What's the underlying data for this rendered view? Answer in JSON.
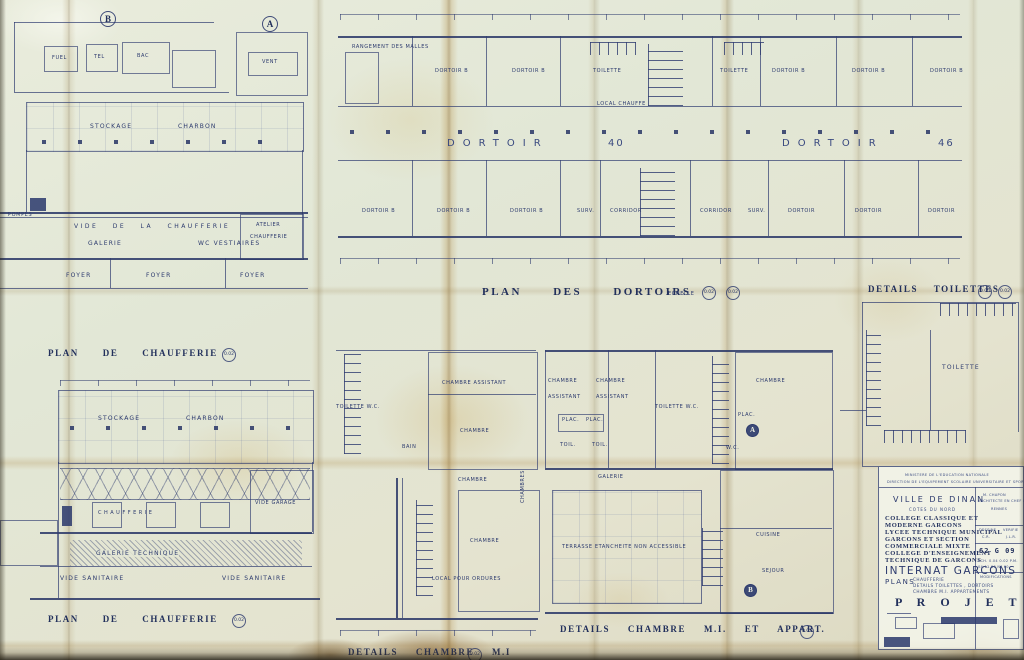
{
  "titles": {
    "plan_dortoirs": "PLAN DES DORTOIRS",
    "details_toilettes": "DETAILS TOILETTES",
    "plan_chaufferie": "PLAN DE CHAUFFERIE",
    "plan_chaufferie2": "PLAN DE CHAUFFERIE",
    "details_chambre": "DETAILS CHAMBRE M.I",
    "details_chambre_appart": "DETAILS CHAMBRE M.I. ET APPART.",
    "echelle": "ECHELLE",
    "s002": "0.02",
    "s005": "0.05"
  },
  "dortoirs": {
    "rangement": "RANGEMENT  DES  MALLES",
    "top_rooms": [
      "DORTOIR  B",
      "DORTOIR  B",
      "TOILETTE",
      "TOILETTE",
      "DORTOIR  B",
      "DORTOIR  B",
      "DORTOIR  B"
    ],
    "hall_left_name": "DORTOIR",
    "hall_left_no": "40",
    "hall_right_name": "DORTOIR",
    "hall_right_no": "46",
    "local": "LOCAL  CHAUFFE",
    "bottom_rooms": [
      "DORTOIR  B",
      "DORTOIR  B",
      "DORTOIR  B",
      "SURV.",
      "CORRIDOR",
      "CORRIDOR",
      "SURV.",
      "DORTOIR",
      "DORTOIR",
      "DORTOIR"
    ]
  },
  "chaufferie_top": {
    "stockage": "STOCKAGE",
    "charbon": "CHARBON",
    "vide": "VIDE  DE  LA  CHAUFFERIE",
    "atelier1": "ATELIER",
    "atelier2": "CHAUFFERIE",
    "galerie": "GALERIE",
    "vestiaires": "WC   VESTIAIRES",
    "pompes": "POMPES",
    "foyer": "FOYER"
  },
  "details_ab": {
    "b": "B",
    "a": "A",
    "fuel": "FUEL",
    "tel": "TEL",
    "bac": "BAC",
    "vent": "VENT"
  },
  "chaufferie_bottom": {
    "stockage": "STOCKAGE",
    "charbon": "CHARBON",
    "chaufferie": "CHAUFFERIE",
    "galerie_technique": "GALERIE   TECHNIQUE",
    "vide_sanitaire": "VIDE  SANITAIRE",
    "vide_garage": "VIDE  GARAGE"
  },
  "chambre_mi": {
    "toilette_wc": "TOILETTE   W.C.",
    "chambre_assistant": "CHAMBRE  ASSISTANT",
    "bain": "BAIN",
    "chambre": "CHAMBRE",
    "local_ordures": "LOCAL  POUR  ORDURES",
    "chambres_vert": "CHAMBRES"
  },
  "appart": {
    "chambre": "CHAMBRE",
    "assistant": "ASSISTANT",
    "toilette_wc": "TOILETTE   W.C.",
    "plac": "PLAC.",
    "toil": "TOIL.",
    "wc": "W.C.",
    "a": "A",
    "b": "B",
    "galerie": "GALERIE",
    "terrasse": "TERRASSE   ETANCHEITE   NON   ACCESSIBLE",
    "cuisine": "CUISINE",
    "sejour": "SEJOUR"
  },
  "toilettes_detail": {
    "toilette": "TOILETTE"
  },
  "title_block": {
    "ministry_line1": "MINISTERE  DE  L'EDUCATION  NATIONALE",
    "ministry_line2": "DIRECTION DE L'EQUIPEMENT SCOLAIRE UNIVERSITAIRE ET SPORTIF",
    "city": "VILLE  DE  DINAN",
    "dept": "COTES  DU  NORD",
    "establishment_lines": [
      "COLLEGE  CLASSIQUE  ET",
      "MODERNE  GARCONS",
      "LYCEE  TECHNIQUE  MUNICIPAL",
      "GARCONS  ET  SECTION",
      "COMMERCIALE  MIXTE",
      "COLLEGE  D'ENSEIGNEMENT",
      "TECHNIQUE  DE  GARCONS"
    ],
    "project": "INTERNAT  GARCONS",
    "plans_label": "PLANS",
    "plans_lines": [
      "CHAUFFERIE",
      "DETAILS  TOILETTES , DORTOIRS",
      "CHAMBRE  M.I.  APPARTEMENTS"
    ],
    "stage": "P R O J E T",
    "architect_name": "M. CHAPON",
    "architect_line1": "ARCHITECTE EN CHEF DES BATIMENTS",
    "architect_line2": "RENNES",
    "table_header1": "DESSINE",
    "table_header2": "VERIFIE",
    "table_value1": "C.R.",
    "table_value2": "J.L.R.",
    "dossier_no": "62 G 09",
    "scale_line": "ECH. 0.04  0.02  P.M.",
    "date_line": "04.11.60   N° 60",
    "modifications": "MODIFICATIONS"
  },
  "colors": {
    "ink": "#2c3a6e",
    "paper": "#e4e7d6",
    "stain": "#c8a050"
  }
}
